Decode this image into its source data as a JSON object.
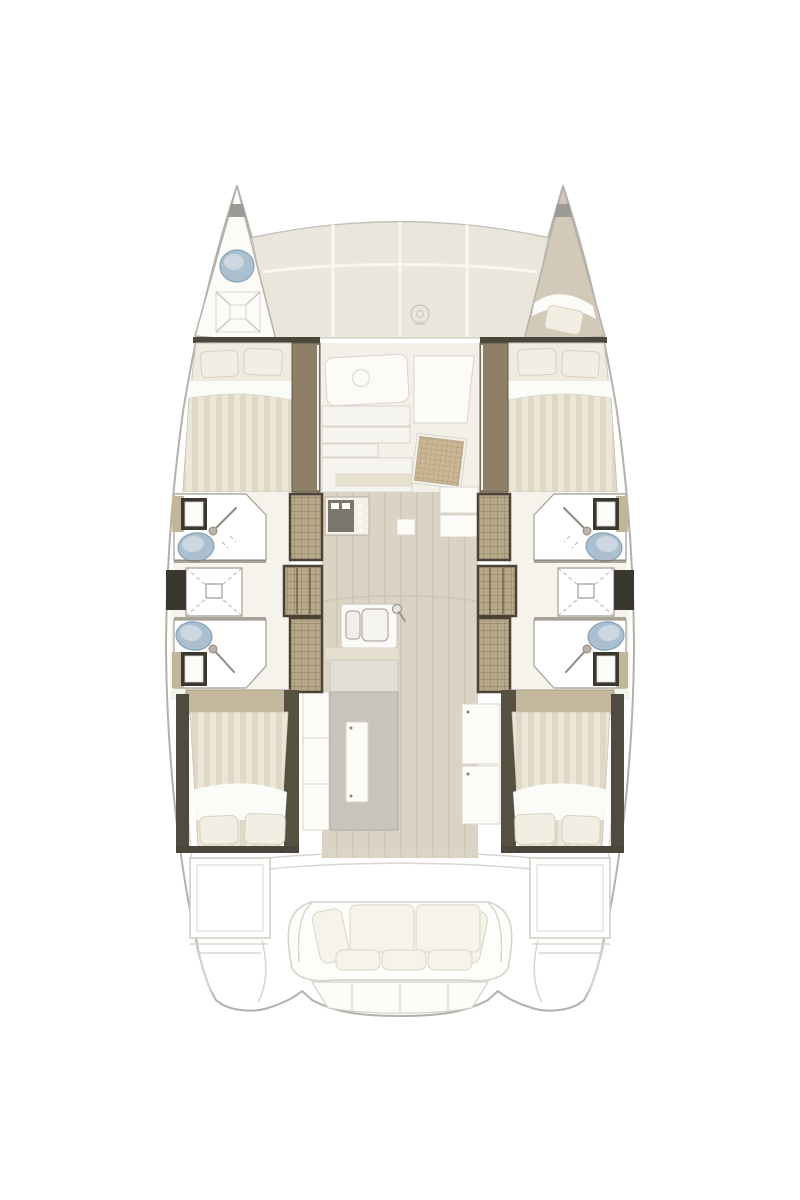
{
  "page": {
    "background": "#ffffff",
    "content_type": "boat floor plan",
    "text_visible": false
  },
  "colors": {
    "hullFill": "#ffffff",
    "outline": "#b3b1aa",
    "outlineSoft": "#d8d6cf",
    "deckPanel": "#eae6db",
    "deckEdge": "#c6c3ba",
    "deckSeam": "#f7f6f1",
    "darkBar": "#4a463b",
    "wallLine": "#6b6557",
    "wood": "#8d8067",
    "woodDark": "#5f5849",
    "stepFill": "#b6a888",
    "stepLine": "#8b7e63",
    "stepFrame": "#4c4336",
    "sideCab": "#c2b69a",
    "mattress": "#efebe0",
    "mattressEdge": "#c9c5bb",
    "stripeA": "#ece6d7",
    "stripeB": "#dfd8c6",
    "pillow": "#f2eee4",
    "pillowEdge": "#d7d1c2",
    "sheet": "#fbfbf8",
    "floorWood": "#dbd4c5",
    "floorLine": "#cec7b7",
    "salonFloor": "#f2f0e9",
    "panelWhite": "#fcfbf8",
    "panelEdge": "#d9d5cb",
    "counter": "#f6f4ee",
    "counterBand": "#e7e0d0",
    "fixtureBlue": "#aabfd0",
    "fixtureBlueDark": "#89a2b4",
    "fixtureBlueLight": "#ccd7e1",
    "sinkFrame": "#3a372e",
    "islandGray": "#c8c4bb",
    "islandEdge": "#aeaaa1",
    "cushion": "#f6f3ea",
    "cushionEdge": "#ded9cb",
    "bowBeige": "#d2c9b8",
    "caneFill": "#cbb795",
    "caneLine": "#a5916c",
    "grayCap": "#9c9a94"
  },
  "floorplan": {
    "vessel_type": "sailing catamaran",
    "view": "overhead deck / accommodation plan",
    "orientation": "bow at top, stern at bottom",
    "symmetry": "port and starboard hulls mirrored",
    "cabins_count": 4,
    "bathrooms_count": 4,
    "areas": {
      "bow_port": {
        "fixtures": [
          "washbasin",
          "anchor-locker-hatch"
        ]
      },
      "bow_starboard": {
        "fixtures": [
          "single-berth",
          "pillow"
        ]
      },
      "foredeck": {
        "fixtures": [
          "three-deck-panels",
          "windlass"
        ]
      },
      "forward_cabin_port": {
        "fixtures": [
          "double-bed",
          "two-pillows",
          "companionway-steps"
        ]
      },
      "forward_cabin_starboard": {
        "fixtures": [
          "double-bed",
          "two-pillows",
          "companionway-steps"
        ]
      },
      "salon": {
        "fixtures": [
          "table",
          "settee-panels",
          "cane-nav-seat",
          "cabinets"
        ]
      },
      "galley": {
        "fixtures": [
          "double-sink",
          "faucet",
          "stove",
          "island-unit-with-door",
          "cabinet-columns"
        ]
      },
      "bathroom_port_forward": {
        "fixtures": [
          "washbasin",
          "toilet",
          "shower-wand"
        ]
      },
      "shower_port": {
        "fixtures": [
          "shower-cubicle",
          "drain"
        ]
      },
      "bathroom_port_aft": {
        "fixtures": [
          "toilet",
          "washbasin",
          "shower-wand"
        ]
      },
      "bathroom_starboard_forward": {
        "fixtures": [
          "washbasin",
          "toilet",
          "shower-wand"
        ]
      },
      "shower_starboard": {
        "fixtures": [
          "shower-cubicle",
          "drain"
        ]
      },
      "bathroom_starboard_aft": {
        "fixtures": [
          "toilet",
          "washbasin",
          "shower-wand"
        ]
      },
      "stairs_port": {
        "fixtures": [
          "three-hatched-steps"
        ]
      },
      "stairs_starboard": {
        "fixtures": [
          "three-hatched-steps"
        ]
      },
      "aft_cabin_port": {
        "fixtures": [
          "double-bed",
          "two-pillows"
        ]
      },
      "aft_cabin_starboard": {
        "fixtures": [
          "double-bed",
          "two-pillows"
        ]
      },
      "cockpit": {
        "fixtures": [
          "two-side-lockers",
          "bench-two-back-cushions",
          "bench-three-seat-cushions",
          "two-side-cushions",
          "transom-steps",
          "two-swim-platforms"
        ]
      }
    }
  }
}
